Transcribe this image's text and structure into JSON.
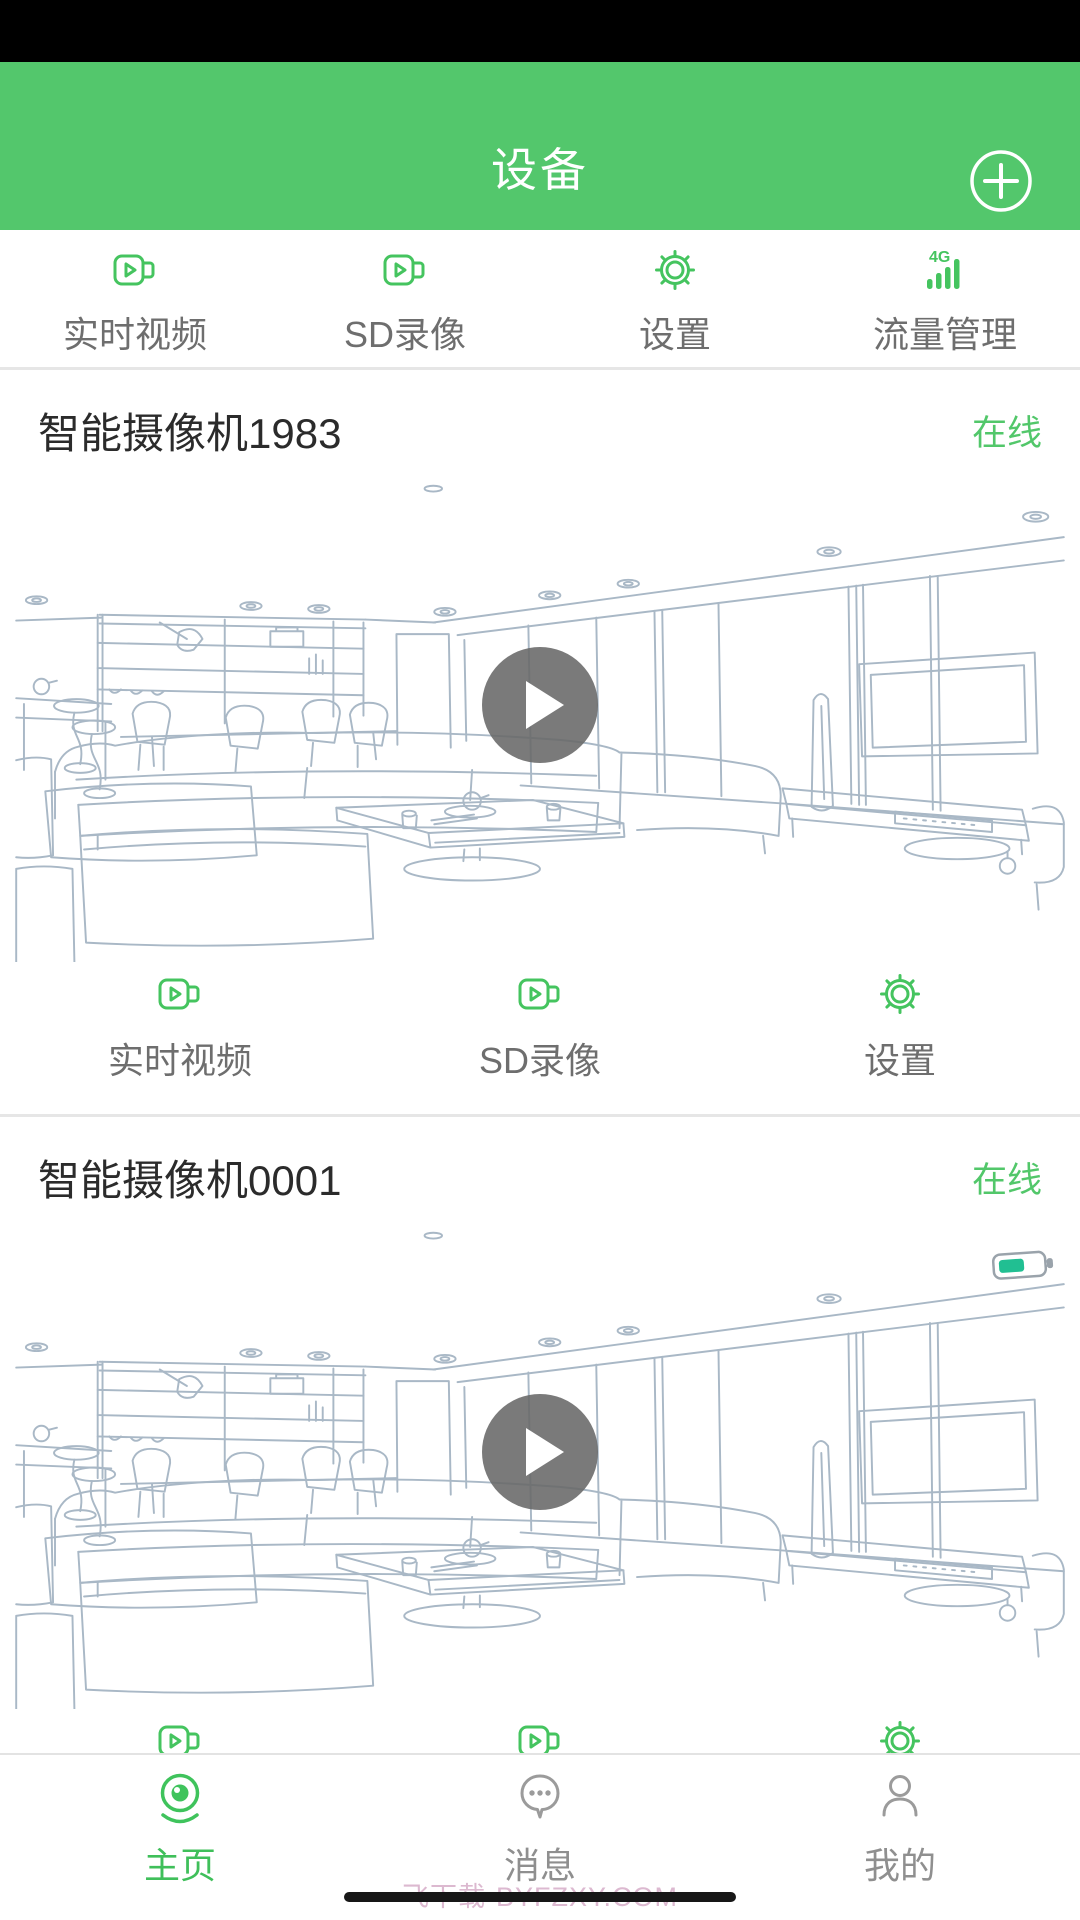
{
  "header": {
    "title": "设备",
    "add_icon": "plus-circle-icon"
  },
  "quick_actions": [
    {
      "label": "实时视频",
      "icon": "video-camera-icon"
    },
    {
      "label": "SD录像",
      "icon": "video-camera-icon"
    },
    {
      "label": "设置",
      "icon": "gear-icon"
    },
    {
      "label": "流量管理",
      "icon": "4g-signal-icon"
    }
  ],
  "cameras": [
    {
      "name": "智能摄像机1983",
      "status": "在线",
      "has_battery_badge": false,
      "actions": [
        {
          "label": "实时视频",
          "icon": "video-camera-icon"
        },
        {
          "label": "SD录像",
          "icon": "video-camera-icon"
        },
        {
          "label": "设置",
          "icon": "gear-icon"
        }
      ]
    },
    {
      "name": "智能摄像机0001",
      "status": "在线",
      "has_battery_badge": true,
      "actions": [
        {
          "label": "实时视频",
          "icon": "video-camera-icon"
        },
        {
          "label": "SD录像",
          "icon": "video-camera-icon"
        },
        {
          "label": "设置",
          "icon": "gear-icon"
        }
      ]
    }
  ],
  "bottom_nav": [
    {
      "label": "主页",
      "icon": "webcam-icon",
      "active": true
    },
    {
      "label": "消息",
      "icon": "message-bubble-icon",
      "active": false
    },
    {
      "label": "我的",
      "icon": "person-icon",
      "active": false
    }
  ],
  "watermark": "飞下载·BYFZXY.COM",
  "colors": {
    "header_green": "#53c76c",
    "icon_green": "#45c45f",
    "status_green": "#52c76a",
    "battery_teal": "#21bf92",
    "label_gray": "#6e6e6e",
    "nav_inactive_gray": "#9b9b9b",
    "sketch_stroke": "#a9b8c6",
    "watermark_pink": "#dcb9d0"
  }
}
